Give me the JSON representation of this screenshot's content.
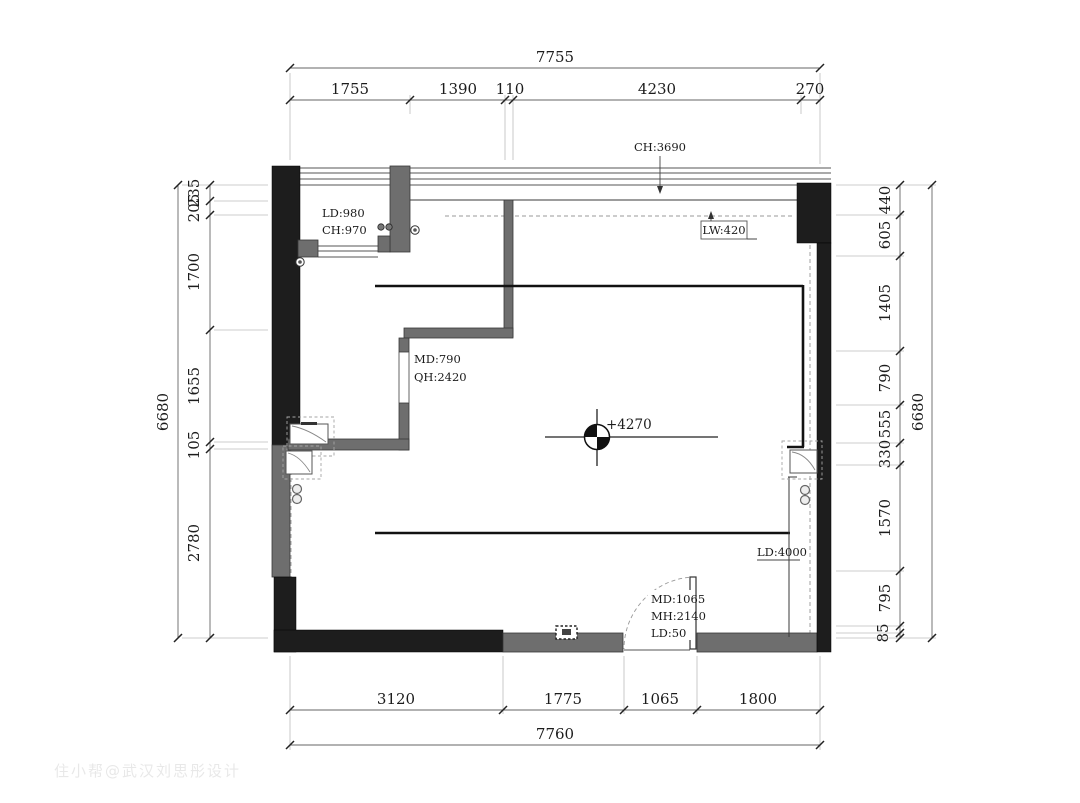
{
  "watermark": "住小帮@武汉刘思彤设计",
  "dims": {
    "top": {
      "total": "7755",
      "segments": [
        "1755",
        "1390",
        "110",
        "4230",
        "270"
      ]
    },
    "bottom": {
      "total": "7760",
      "segments": [
        "3120",
        "1775",
        "1065",
        "1800"
      ]
    },
    "left": {
      "total": "6680",
      "segments": [
        "235",
        "205",
        "1700",
        "1655",
        "105",
        "2780"
      ]
    },
    "right": {
      "total": "6680",
      "segments": [
        "440",
        "605",
        "1405",
        "790",
        "555",
        "330",
        "1570",
        "795",
        "85"
      ]
    }
  },
  "labels": {
    "ceiling_height": "CH:3690",
    "balcony_drop": "LD:980",
    "balcony_height": "CH:970",
    "light_trough_width": "LW:420",
    "passage_width": "MD:790",
    "passage_height": "QH:2420",
    "elevation": "+4270",
    "ceiling_drop": "LD:4000",
    "door_width": "MD:1065",
    "door_height": "MH:2140",
    "door_drop": "LD:50"
  },
  "colors": {
    "wall_black": "#1d1d1d",
    "wall_gray": "#6e6e6e",
    "line": "#1c1c1c"
  }
}
